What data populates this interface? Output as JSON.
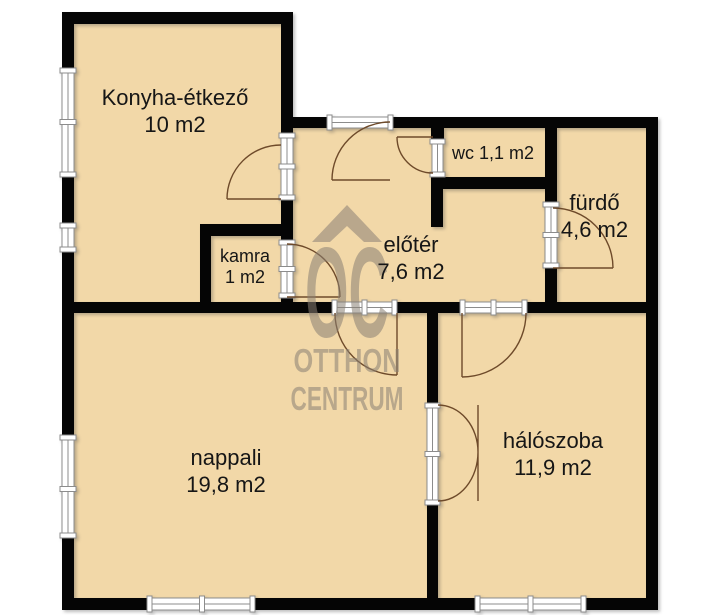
{
  "plan": {
    "colors": {
      "background": "#ffffff",
      "wall": "#050505",
      "room_fill": "#f2d8a8",
      "frame_stroke": "#8c8c8c",
      "door_arc": "#6e4a2a",
      "watermark": "#8a8074",
      "label": "#161616"
    },
    "rooms": [
      {
        "name": "Konyha-étkező",
        "area": "10 m2"
      },
      {
        "name": "kamra",
        "area": "1 m2"
      },
      {
        "name": "wc",
        "area": "1,1 m2"
      },
      {
        "name": "előtér",
        "area": "7,6 m2"
      },
      {
        "name": "fürdő",
        "area": "4,6 m2"
      },
      {
        "name": "nappali",
        "area": "19,8 m2"
      },
      {
        "name": "hálószoba",
        "area": "11,9 m2"
      }
    ],
    "watermark": {
      "monogram": "OC",
      "line1": "OTTHON",
      "line2": "CENTRUM"
    }
  }
}
